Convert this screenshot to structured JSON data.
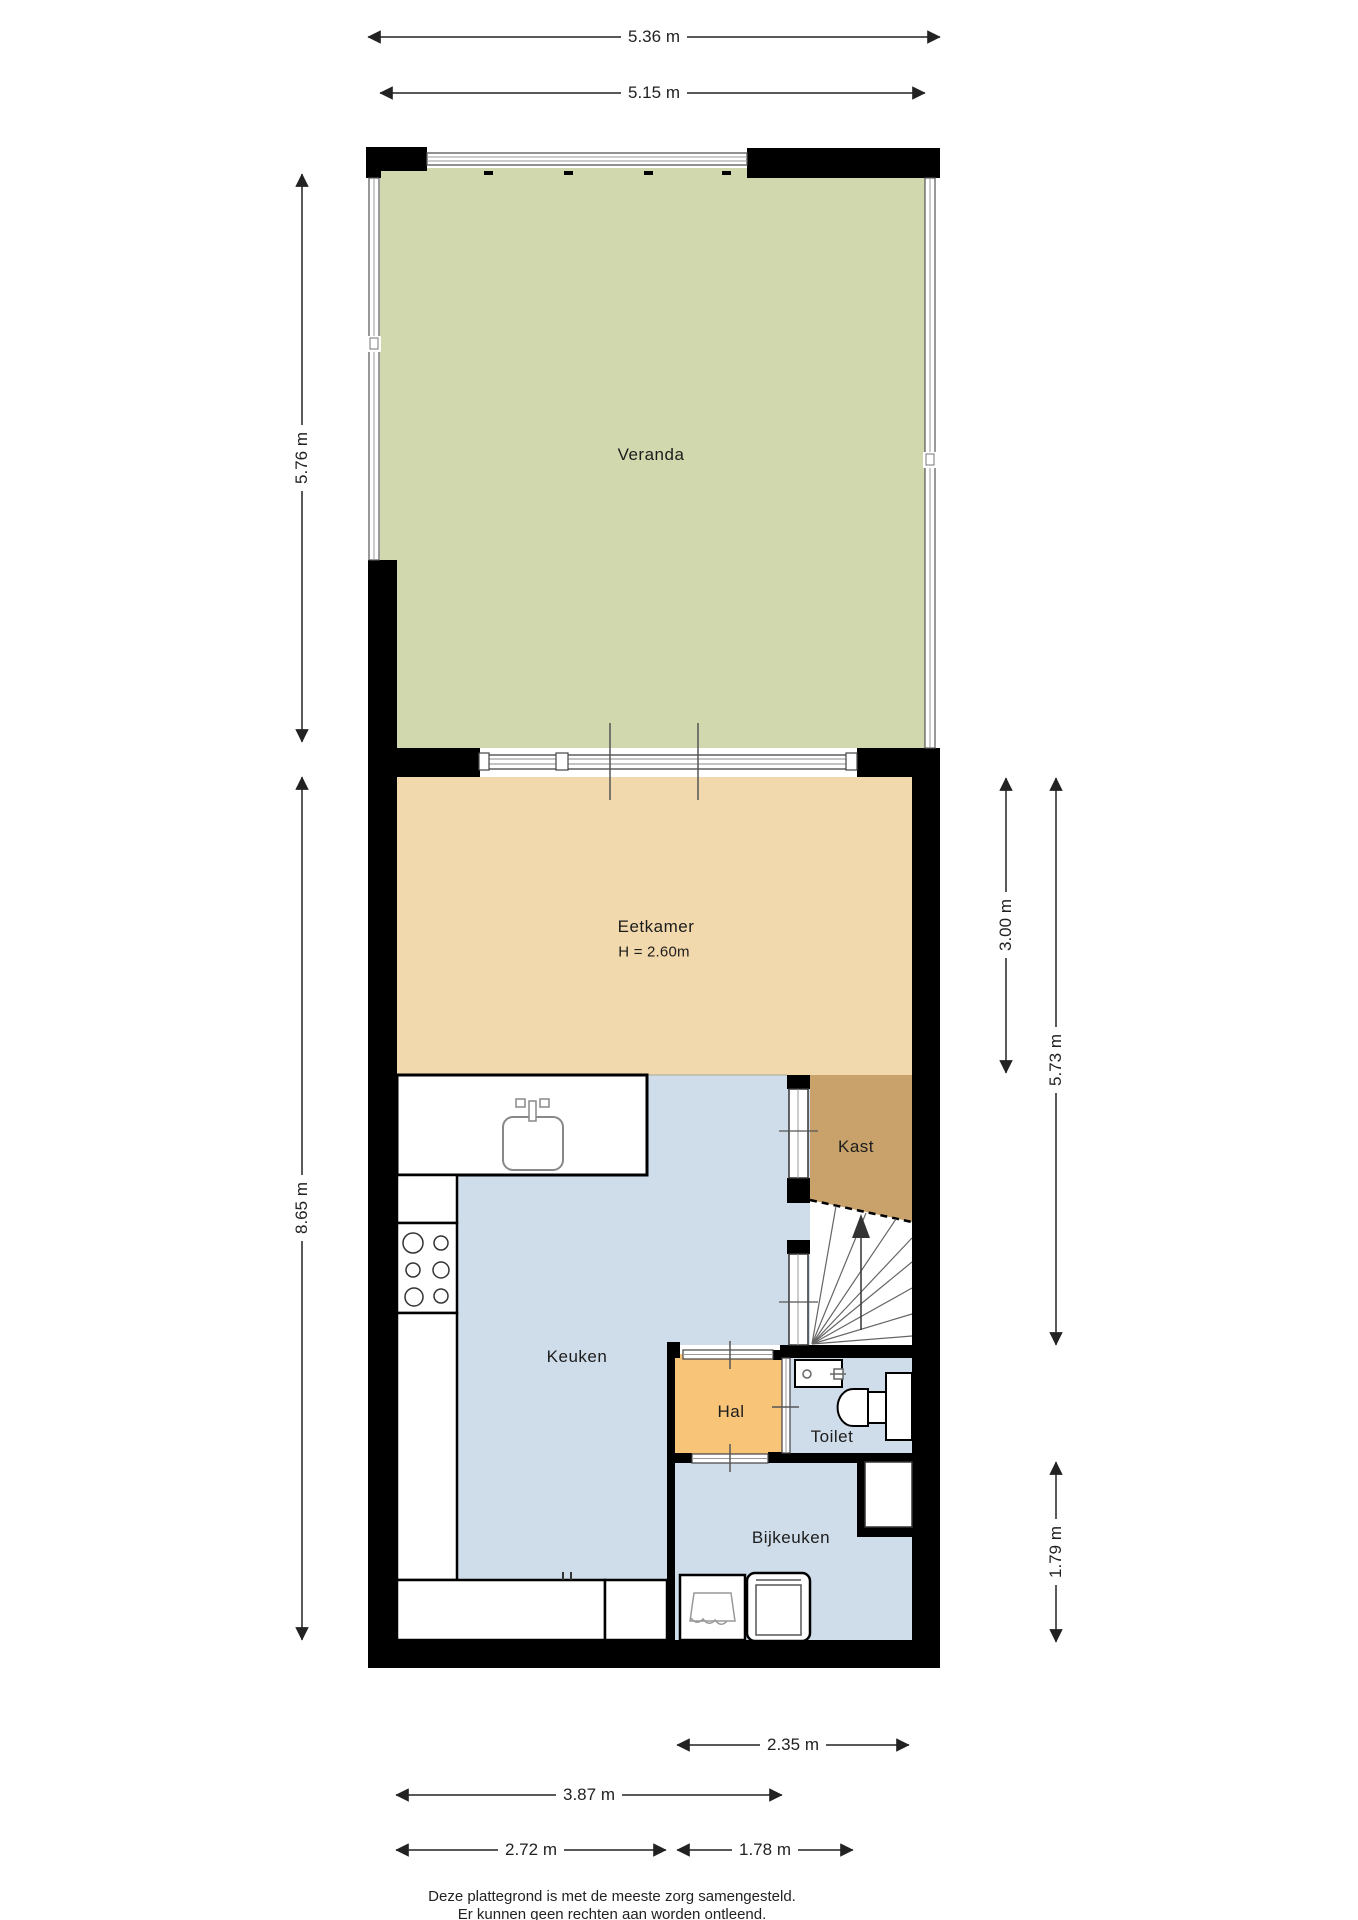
{
  "labels": {
    "veranda": "Veranda",
    "eetkamer": "Eetkamer",
    "eetkamer_height": "H = 2.60m",
    "kast": "Kast",
    "keuken": "Keuken",
    "hal": "Hal",
    "toilet": "Toilet",
    "bijkeuken": "Bijkeuken"
  },
  "dimensions": {
    "top_outer": "5.36 m",
    "top_inner": "5.15 m",
    "left_veranda": "5.76 m",
    "left_house": "8.65 m",
    "right_eetkamer": "3.00 m",
    "right_mid": "5.73 m",
    "right_bijkeuken": "1.79 m",
    "bottom_bijkeuken": "2.35 m",
    "bottom_keuken": "3.87 m",
    "bottom_keuken_left": "2.72 m",
    "bottom_hal": "1.78 m"
  },
  "footer": {
    "line1": "Deze plattegrond is met de meeste zorg samengesteld.",
    "line2": "Er kunnen geen rechten aan worden ontleend."
  },
  "colors": {
    "veranda": "#d2d8ae",
    "eetkamer": "#f2d9ad",
    "keuken": "#cfdcea",
    "kast": "#c8a26a",
    "hal": "#f8c578",
    "wall": "#000000",
    "stairs": "#ffffff",
    "dimension": "#222222"
  }
}
